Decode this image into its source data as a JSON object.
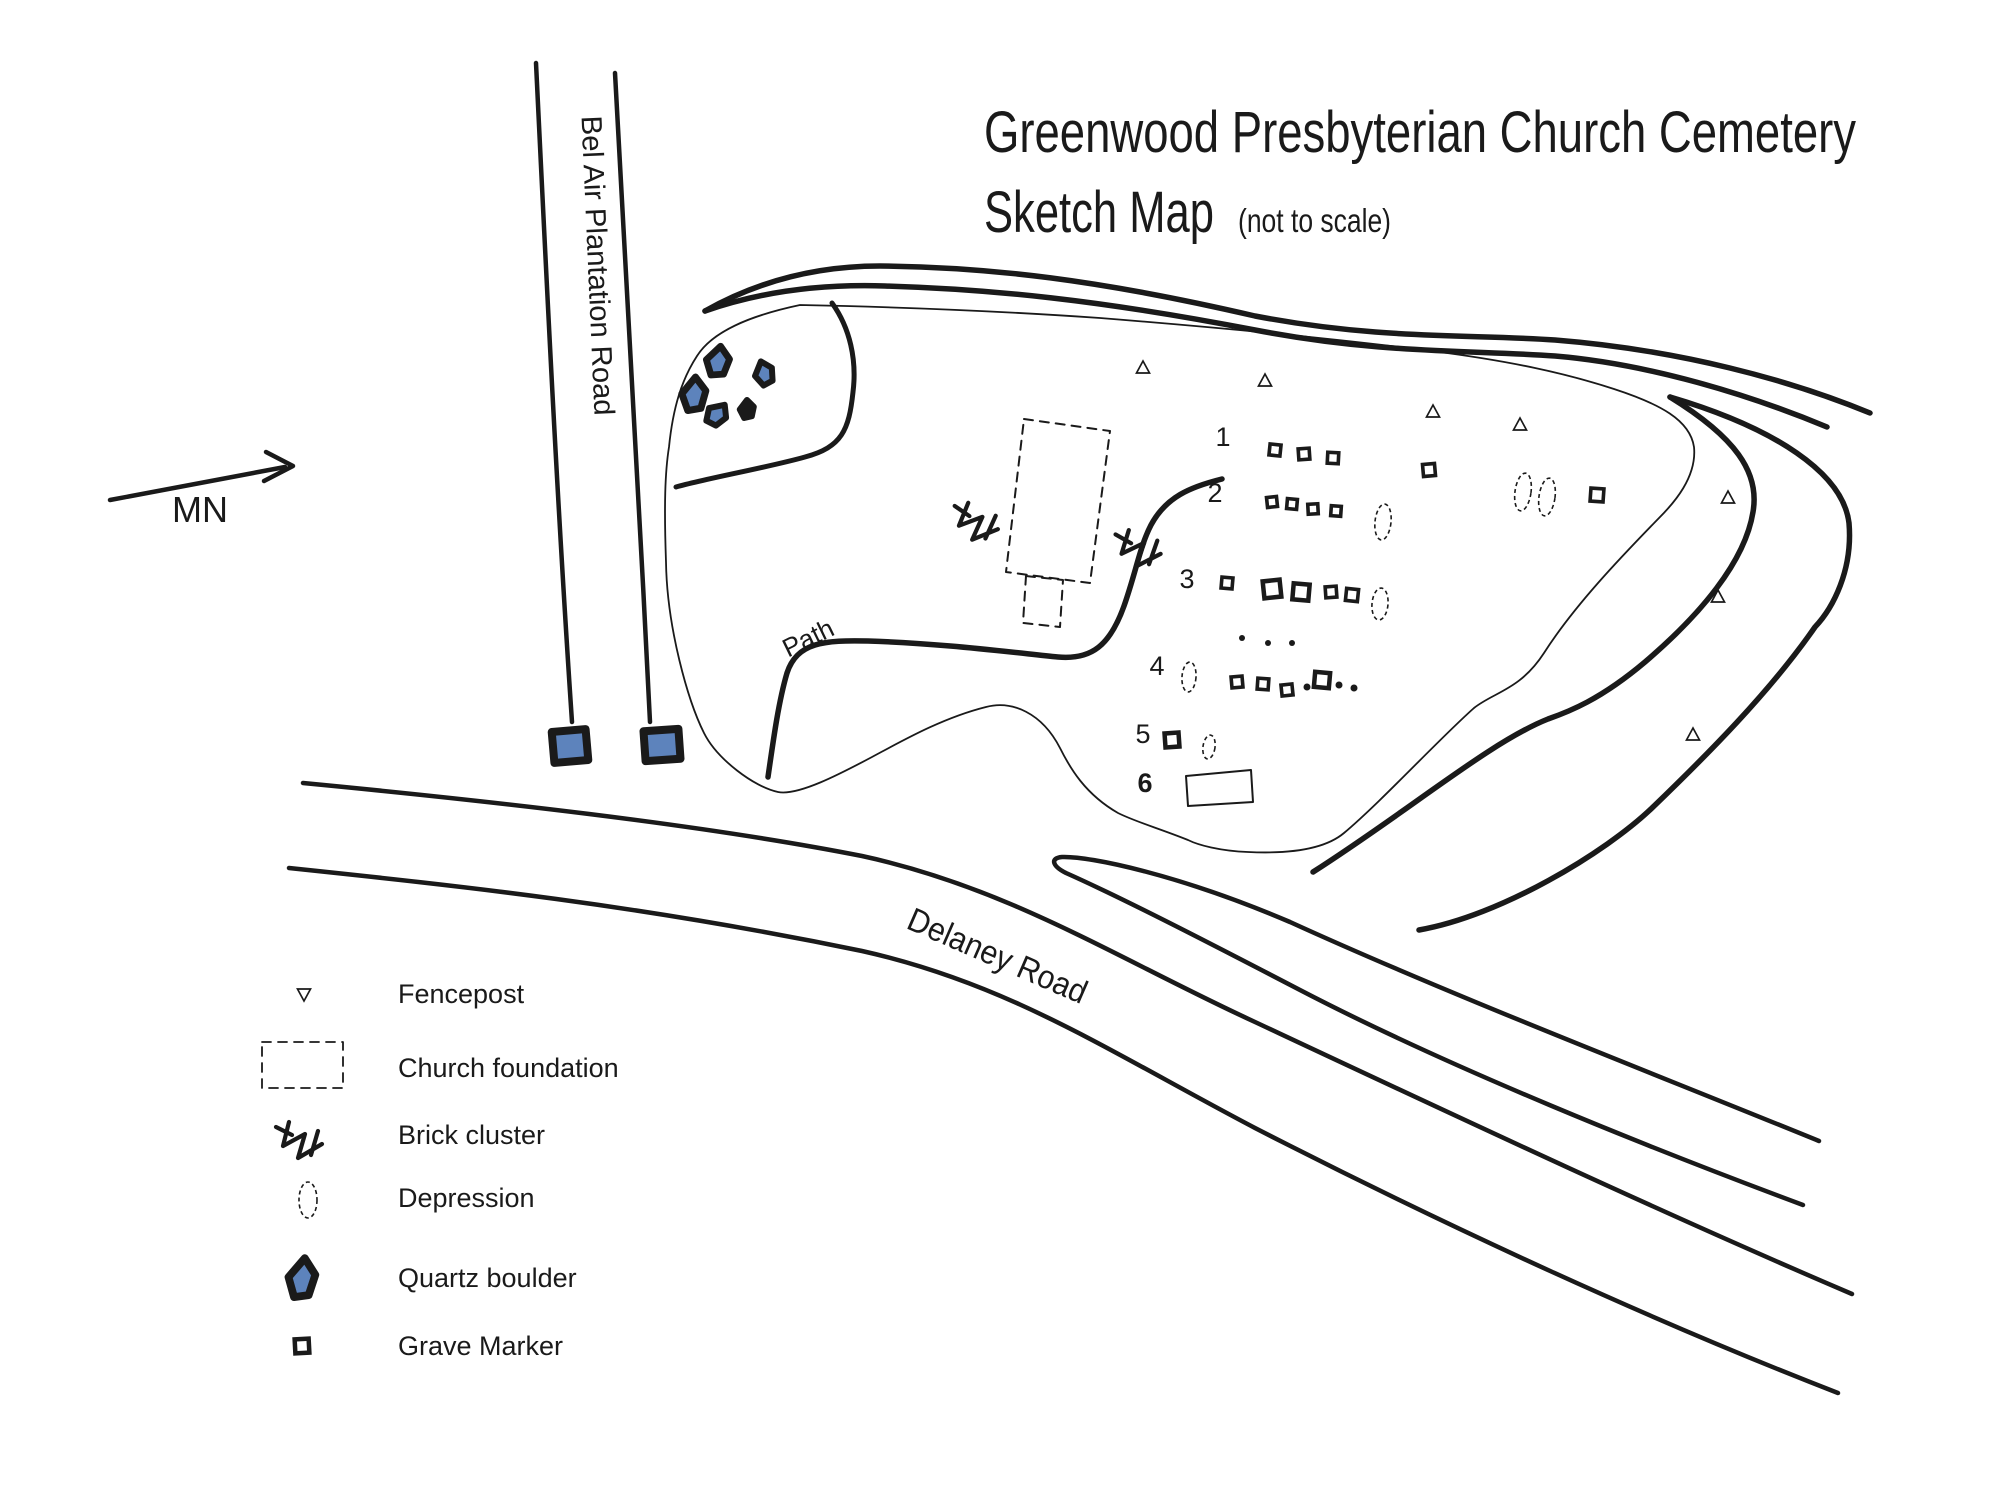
{
  "title": {
    "line1": "Greenwood Presbyterian Church Cemetery",
    "line2": "Sketch Map",
    "note": "(not to scale)"
  },
  "labels": {
    "vertical_road": "Bel Air Plantation Road",
    "diagonal_road": "Delaney Road",
    "path": "Path",
    "magnetic_north": "MN"
  },
  "legend": {
    "items": [
      {
        "symbol": "fencepost",
        "label": "Fencepost"
      },
      {
        "symbol": "church-foundation",
        "label": "Church foundation"
      },
      {
        "symbol": "brick-cluster",
        "label": "Brick cluster"
      },
      {
        "symbol": "depression",
        "label": "Depression"
      },
      {
        "symbol": "quartz-boulder",
        "label": "Quartz boulder"
      },
      {
        "symbol": "grave-marker",
        "label": "Grave Marker"
      }
    ]
  },
  "colors": {
    "ink": "#1a1a1a",
    "quartz_blue": "#5d83bc",
    "paper": "#ffffff"
  },
  "map_symbols": {
    "row_labels": [
      {
        "t": "1",
        "x": 1223,
        "y": 446
      },
      {
        "t": "2",
        "x": 1215,
        "y": 502
      },
      {
        "t": "3",
        "x": 1187,
        "y": 588
      },
      {
        "t": "4",
        "x": 1157,
        "y": 675
      },
      {
        "t": "5",
        "x": 1143,
        "y": 743
      },
      {
        "t": "6",
        "x": 1145,
        "y": 792,
        "bold": true
      }
    ],
    "fenceposts": [
      {
        "x": 1143,
        "y": 368
      },
      {
        "x": 1265,
        "y": 381
      },
      {
        "x": 1433,
        "y": 412
      },
      {
        "x": 1520,
        "y": 425
      },
      {
        "x": 1728,
        "y": 498
      },
      {
        "x": 1718,
        "y": 597
      },
      {
        "x": 1693,
        "y": 735
      },
      {
        "x": 304,
        "y": 994,
        "flip": true
      }
    ],
    "grave_markers": [
      {
        "x": 1275,
        "y": 450,
        "s": 11,
        "r": 6
      },
      {
        "x": 1304,
        "y": 454,
        "s": 11,
        "r": -4
      },
      {
        "x": 1333,
        "y": 458,
        "s": 11,
        "r": 3
      },
      {
        "x": 1429,
        "y": 470,
        "s": 12,
        "r": -5
      },
      {
        "x": 1597,
        "y": 495,
        "s": 13,
        "r": 4
      },
      {
        "x": 1272,
        "y": 502,
        "s": 10,
        "r": -6
      },
      {
        "x": 1292,
        "y": 504,
        "s": 10,
        "r": 5
      },
      {
        "x": 1313,
        "y": 509,
        "s": 10,
        "r": -3
      },
      {
        "x": 1336,
        "y": 511,
        "s": 10,
        "r": 4
      },
      {
        "x": 1227,
        "y": 583,
        "s": 11,
        "r": 5
      },
      {
        "x": 1272,
        "y": 589,
        "s": 17,
        "r": -6
      },
      {
        "x": 1301,
        "y": 592,
        "s": 16,
        "r": 5
      },
      {
        "x": 1331,
        "y": 592,
        "s": 11,
        "r": -4
      },
      {
        "x": 1352,
        "y": 595,
        "s": 12,
        "r": 6
      },
      {
        "x": 1237,
        "y": 682,
        "s": 11,
        "r": -5
      },
      {
        "x": 1263,
        "y": 684,
        "s": 11,
        "r": 4
      },
      {
        "x": 1287,
        "y": 690,
        "s": 11,
        "r": -6
      },
      {
        "x": 1322,
        "y": 680,
        "s": 15,
        "r": 5
      },
      {
        "x": 1172,
        "y": 740,
        "s": 14,
        "r": -4
      },
      {
        "x": 302,
        "y": 1346,
        "s": 14,
        "r": -3
      }
    ],
    "dots": [
      {
        "x": 1242,
        "y": 638,
        "r": 3
      },
      {
        "x": 1268,
        "y": 643,
        "r": 3
      },
      {
        "x": 1292,
        "y": 643,
        "r": 3
      },
      {
        "x": 1307,
        "y": 687,
        "r": 3.5
      },
      {
        "x": 1339,
        "y": 685,
        "r": 3.5
      },
      {
        "x": 1354,
        "y": 688,
        "r": 3.5
      }
    ],
    "depressions": [
      {
        "x": 1523,
        "y": 492,
        "rx": 8,
        "ry": 19,
        "rot": 8
      },
      {
        "x": 1547,
        "y": 497,
        "rx": 8,
        "ry": 19,
        "rot": 8
      },
      {
        "x": 1383,
        "y": 522,
        "rx": 8,
        "ry": 18,
        "rot": 6
      },
      {
        "x": 1380,
        "y": 604,
        "rx": 8,
        "ry": 16,
        "rot": 5
      },
      {
        "x": 1189,
        "y": 677,
        "rx": 7,
        "ry": 15,
        "rot": 4
      },
      {
        "x": 1209,
        "y": 747,
        "rx": 6,
        "ry": 12,
        "rot": 8
      },
      {
        "x": 308,
        "y": 1200,
        "rx": 9,
        "ry": 18,
        "rot": 0
      }
    ],
    "boulders": [
      {
        "x": 718,
        "y": 361,
        "w": 26,
        "h": 30,
        "rot": 10
      },
      {
        "x": 764,
        "y": 373,
        "w": 21,
        "h": 24,
        "rot": -15
      },
      {
        "x": 694,
        "y": 394,
        "w": 27,
        "h": 34,
        "rot": 5
      },
      {
        "x": 717,
        "y": 414,
        "w": 22,
        "h": 24,
        "rot": 40
      },
      {
        "x": 747,
        "y": 409,
        "w": 16,
        "h": 18,
        "rot": 0,
        "solid": true
      },
      {
        "x": 302,
        "y": 1278,
        "w": 30,
        "h": 40,
        "rot": 8
      }
    ],
    "gate_posts": [
      {
        "x": 570,
        "y": 746,
        "w": 34,
        "h": 31,
        "rot": -5
      },
      {
        "x": 662,
        "y": 745,
        "w": 35,
        "h": 30,
        "rot": -4
      }
    ],
    "brick_clusters": [
      {
        "x": 983,
        "y": 520,
        "rot": 8
      },
      {
        "x": 1145,
        "y": 546,
        "rot": 3
      },
      {
        "x": 306,
        "y": 1137,
        "rot": 0
      }
    ]
  }
}
